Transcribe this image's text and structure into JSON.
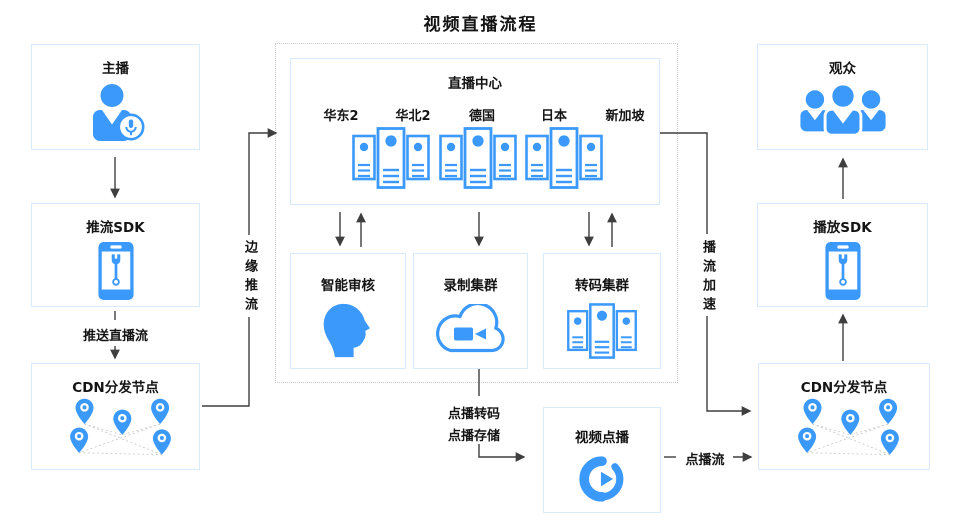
{
  "title": "视频直播流程",
  "colors": {
    "primary_blue": "#3b99fc",
    "box_border": "#d9eafc",
    "dashed_border": "#c9c9c9",
    "connector": "#3f3f3f",
    "text": "#141414",
    "mesh_dotted": "#c9c9c9"
  },
  "nodes": {
    "anchor": {
      "label": "主播",
      "icon": "person-microphone-icon"
    },
    "push_sdk": {
      "label": "推流SDK",
      "icon": "phone-wrench-icon"
    },
    "cdn_left": {
      "label": "CDN分发节点",
      "icon": "map-pins-mesh-icon"
    },
    "live_center": {
      "label": "直播中心",
      "regions": [
        "华东2",
        "华北2",
        "德国",
        "日本",
        "新加坡"
      ],
      "icon": "server-cluster-icon"
    },
    "smart_review": {
      "label": "智能审核",
      "icon": "head-profile-icon"
    },
    "recording_cluster": {
      "label": "录制集群",
      "icon": "cloud-camera-icon"
    },
    "transcoding_cluster": {
      "label": "转码集群",
      "icon": "server-cluster-icon"
    },
    "vod": {
      "label": "视频点播",
      "icon": "vod-cloud-play-icon"
    },
    "audience": {
      "label": "观众",
      "icon": "audience-group-icon"
    },
    "play_sdk": {
      "label": "播放SDK",
      "icon": "phone-wrench-icon"
    },
    "cdn_right": {
      "label": "CDN分发节点",
      "icon": "map-pins-mesh-icon"
    }
  },
  "flow_labels": {
    "push_live_stream": "推送直播流",
    "edge_push": "边缘推流",
    "play_accel": "播流加速",
    "vod_transcode": "点播转码",
    "vod_storage": "点播存储",
    "vod_stream": "点播流"
  }
}
